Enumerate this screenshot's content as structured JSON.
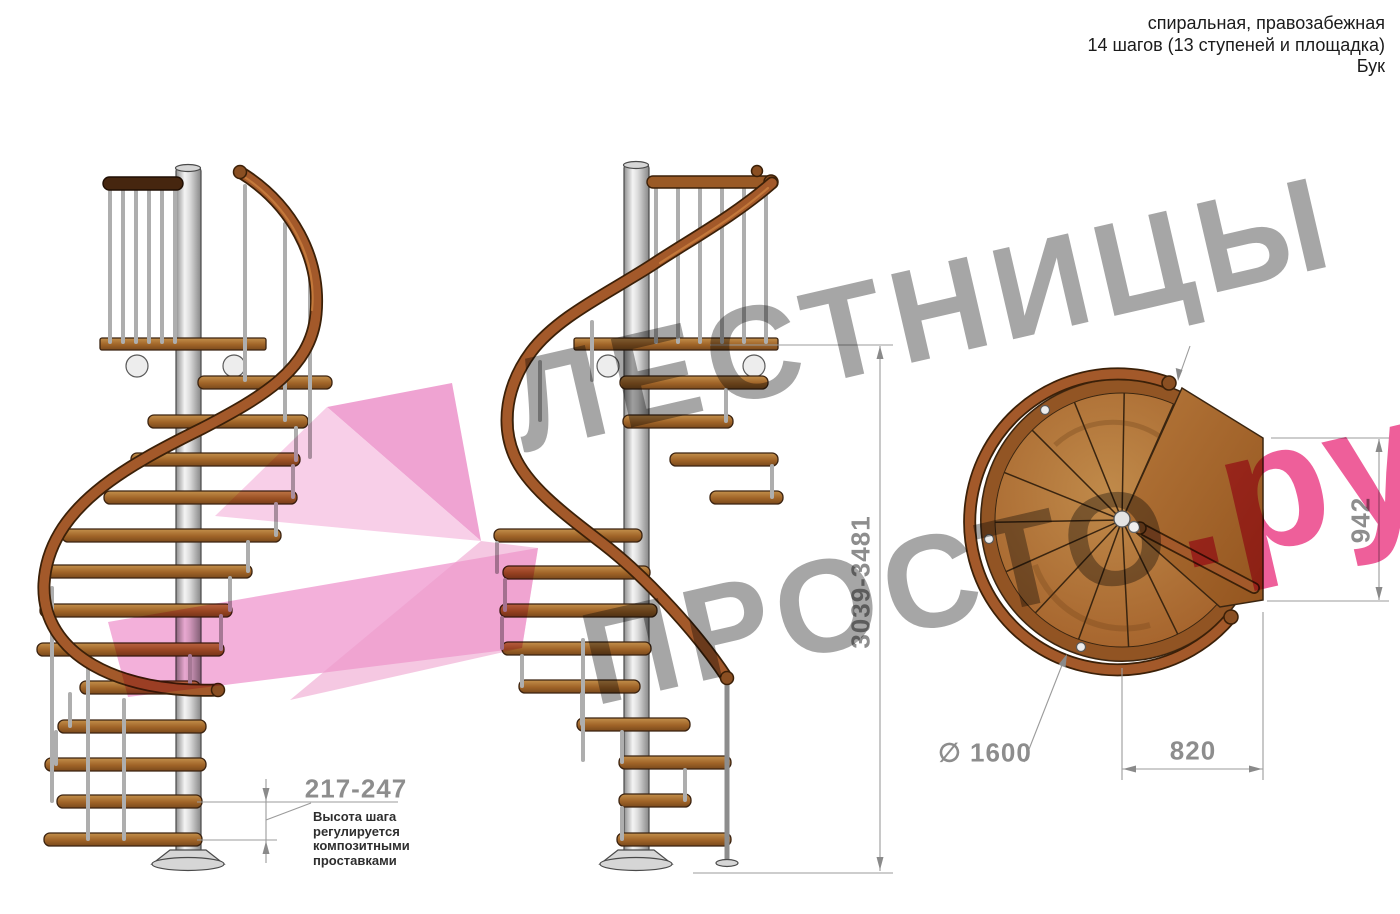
{
  "header": {
    "line1": "спиральная, правозабежная",
    "line2": "14 шагов (13 ступеней и площадка)",
    "line3": "Бук"
  },
  "watermark": {
    "line1": "ЛЕСТНИЦЫ",
    "line2_gray": "ПРОСТО",
    "line2_pink": ".ру"
  },
  "dimensions": {
    "total_height": "3039-3481",
    "landing_depth": "942",
    "diameter": "∅ 1600",
    "landing_width": "820",
    "step_height": "217-247"
  },
  "note": {
    "text": "Высота шага регулируется композитными проставками"
  },
  "colors": {
    "wood_step": "#a06428",
    "handrail": "#a3592a",
    "dark_rail": "#46260f",
    "pole_metal": "#d9d9d9",
    "dimension_gray": "#8d8d8d",
    "watermark_gray": "#a6a6a6",
    "watermark_pink": "#ee5f9a",
    "arrow_pink": "#f3b0da"
  }
}
